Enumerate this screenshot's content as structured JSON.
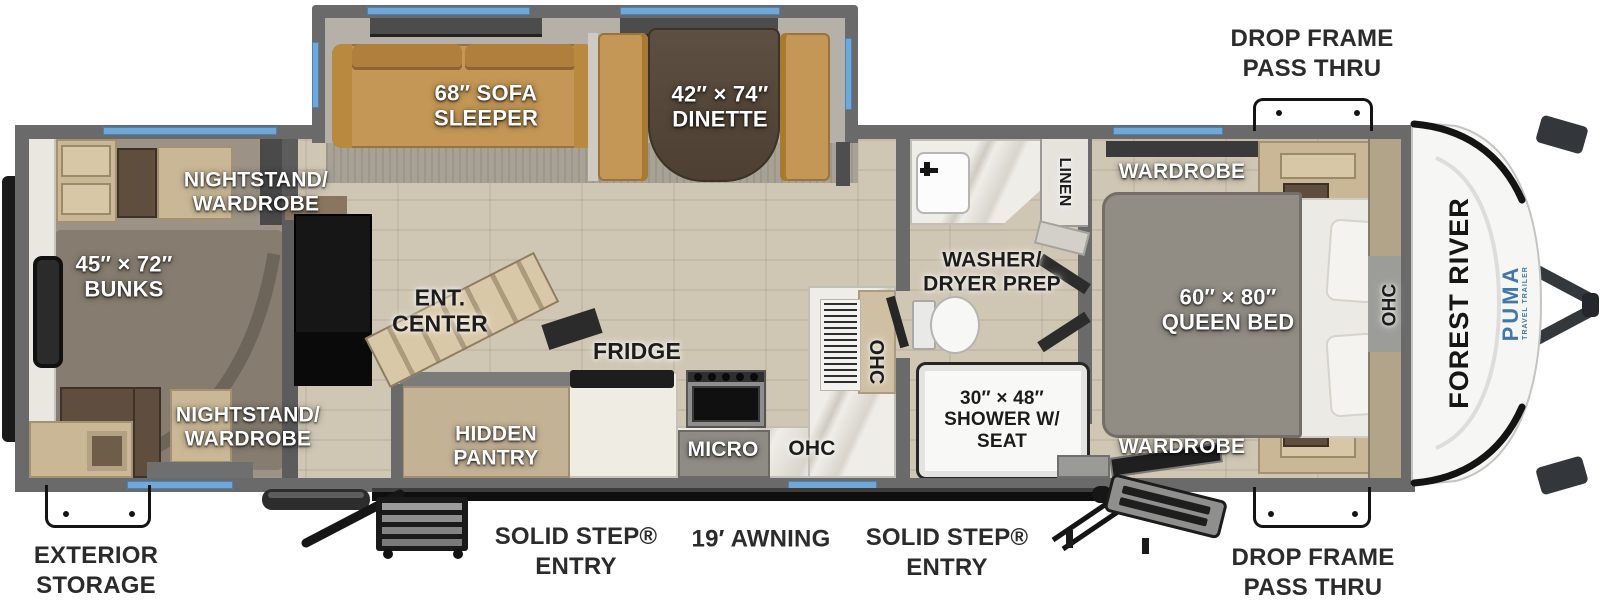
{
  "floorplan": {
    "brand": {
      "manufacturer": "FOREST RIVER",
      "model": "PUMA",
      "model_sub": "TRAVEL TRAILER"
    },
    "exterior_labels": {
      "drop_frame_top": "DROP FRAME\nPASS THRU",
      "drop_frame_bottom": "DROP FRAME\nPASS THRU",
      "exterior_storage": "EXTERIOR\nSTORAGE",
      "solid_step_left": "SOLID STEP®\nENTRY",
      "solid_step_right": "SOLID STEP®\nENTRY",
      "awning": "19′ AWNING"
    },
    "room_labels": {
      "sofa": "68″ SOFA\nSLEEPER",
      "dinette": "42″ × 74″\nDINETTE",
      "nightstand_top": "NIGHTSTAND/\nWARDROBE",
      "nightstand_bottom": "NIGHTSTAND/\nWARDROBE",
      "bunks": "45″ × 72″\nBUNKS",
      "ent_center": "ENT.\nCENTER",
      "hidden_pantry": "HIDDEN\nPANTRY",
      "fridge": "FRIDGE",
      "micro": "MICRO",
      "ohc_kitchen": "OHC",
      "ohc_kitchen_wall": "OHC",
      "ohc_bedroom": "OHC",
      "washer_dryer": "WASHER/\nDRYER PREP",
      "linen": "LINEN",
      "shower": "30″ × 48″\nSHOWER W/\nSEAT",
      "wardrobe_top": "WARDROBE",
      "wardrobe_bottom": "WARDROBE",
      "queen_bed": "60″ × 80″\nQUEEN BED"
    },
    "colors": {
      "window_blue": "#6fa9da",
      "wall_gray": "#6e6e6e",
      "sofa_tan": "#c49756",
      "brand_blue": "#4178a8",
      "floor_wood": "#cfc6b3",
      "bunk_carpet": "#9c9286"
    }
  }
}
